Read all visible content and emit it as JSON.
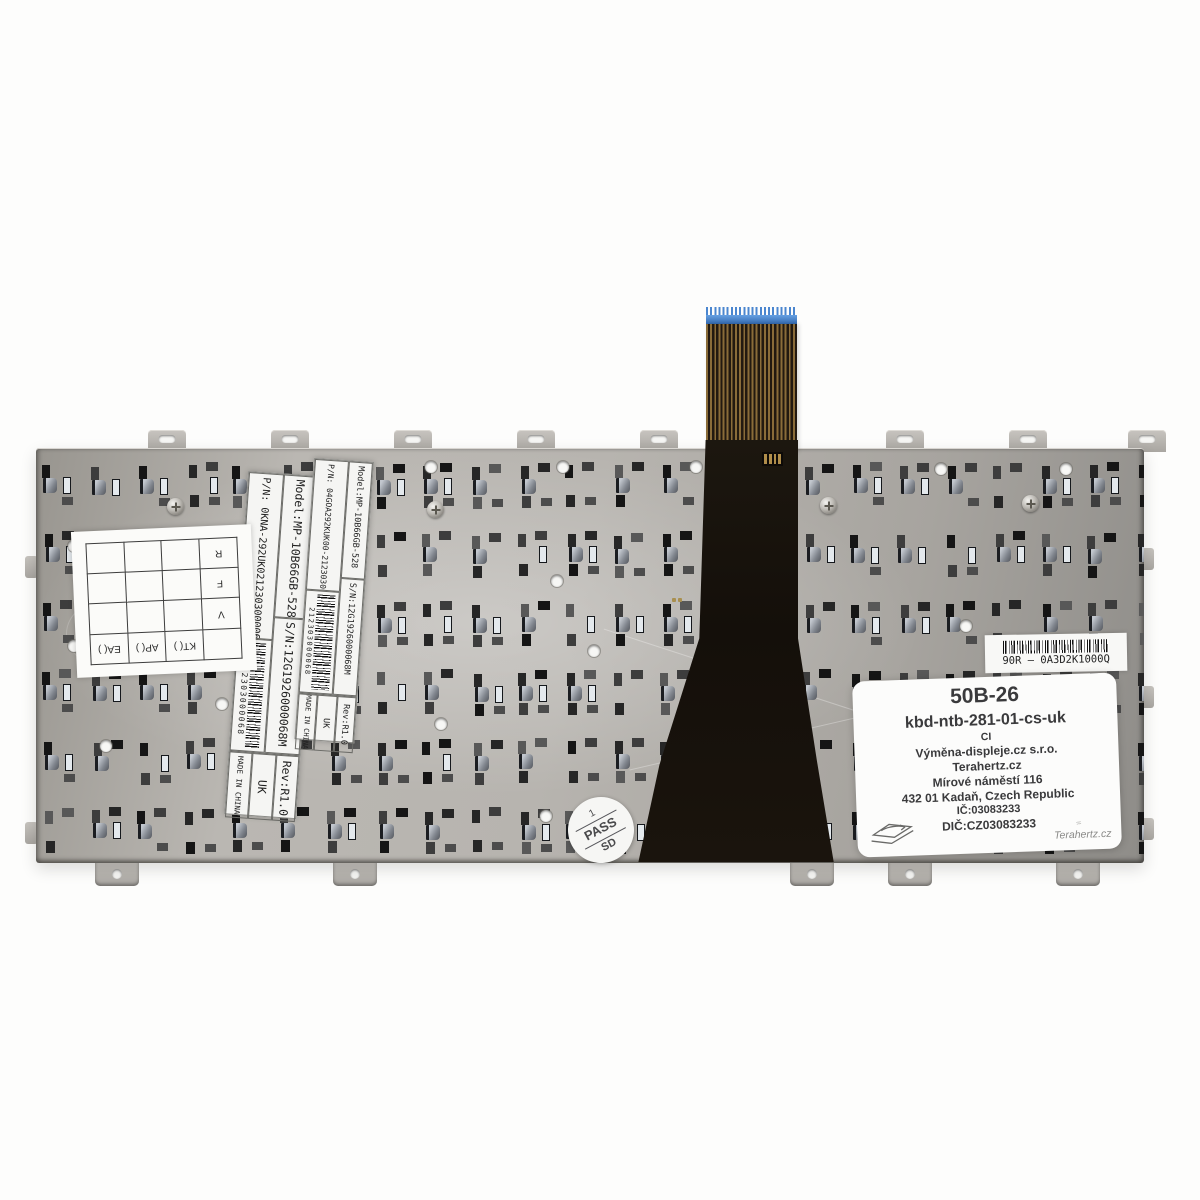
{
  "colors": {
    "plate_metal": "#b2afaa",
    "cable_tip_blue": "#4b86cf",
    "cable_trace_gold": "#8a6c39",
    "cable_black": "#17120c",
    "sticker_text": "#3a3a3c"
  },
  "labels": {
    "large": {
      "model": "Model:MP-10B66GB-528",
      "serial": "S/N:12G1926000068M",
      "rev": "Rev:R1.0",
      "pn": "P/N:  0KNA-292UK0212303000068",
      "uk": "UK",
      "made_in": "MADE IN CHINA",
      "barcode_digits": "0212303000068"
    },
    "small": {
      "model": "Model:MP-10B66GB-528",
      "serial": "S/N:12G1926000068M",
      "rev": "Rev:R1.0",
      "pn": "P/N: 04GOA292KUK00-212303000068",
      "uk": "UK",
      "made_in": "MADE IN CHINA",
      "barcode_digits": "212303000068"
    },
    "asus_barcode_label": {
      "text": "90R – 0A3D2K1000Q"
    }
  },
  "qc_grid": {
    "columns": [
      "KT( )",
      "AP( )",
      "EA( )"
    ],
    "rows": [
      "V",
      "F",
      "R"
    ]
  },
  "stamp": {
    "line1": "1",
    "line2": "PASS",
    "line3": "SD"
  },
  "etched_code": "05A300900LP4101",
  "reseller_sticker": {
    "code": "50B-26",
    "sku": "kbd-ntb-281-01-cs-uk",
    "line_ci": "CI",
    "company": "Výměna-displeje.cz s.r.o.",
    "brand": "Terahertz.cz",
    "street": "Mírové náměstí 116",
    "city": "432 01 Kadaň, Czech Republic",
    "ic": "IČ:03083233",
    "dic": "DIČ:CZ03083233",
    "signature": "Terahertz.cz"
  }
}
